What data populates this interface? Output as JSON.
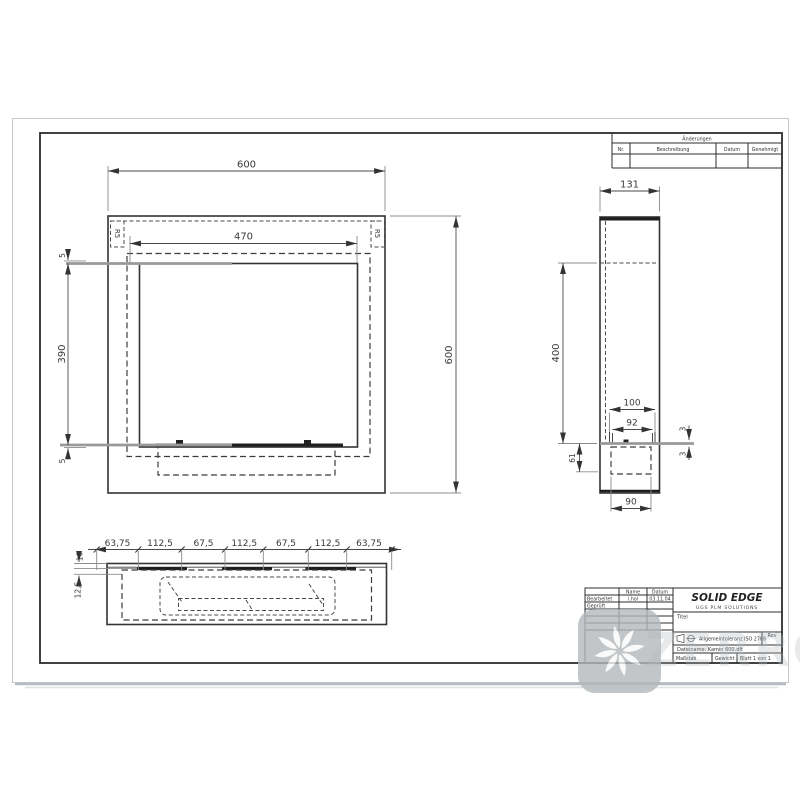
{
  "watermark": {
    "text": "ZERRO"
  },
  "revision_table": {
    "header": "Änderungen",
    "col_nr": "Nr.",
    "col_desc": "Beschreibung",
    "col_date": "Datum",
    "col_appr": "Genehmigt"
  },
  "title_block": {
    "brand": "SOLID EDGE",
    "brand_sub": "UGS PLM SOLUTIONS",
    "col_name": "Name",
    "col_date": "Datum",
    "row1_label": "Bearbeitet",
    "row1_name": "i.hol",
    "row1_date": "03.11.04",
    "row2_label": "Geprüft",
    "title_label": "Titel",
    "tolerance_note": "Allgemeintoleranz ISO 2768",
    "rev_label": "Rev",
    "filename": "Dateiname: Kamin 600.dft",
    "scale_label": "Maßstab",
    "weight_label": "Gewicht",
    "sheet_label": "Blatt 1 von 1"
  },
  "front_view": {
    "width": "600",
    "height": "600",
    "inner_width": "470",
    "inner_height": "390",
    "gap_top": "5",
    "gap_bottom": "5",
    "corner_left": "R5",
    "corner_right": "R5"
  },
  "side_view": {
    "width": "131",
    "height": "400",
    "slot_outer": "100",
    "slot_inner": "92",
    "lip_top": "3",
    "lip_bottom": "3",
    "inset": "61",
    "base_width": "90"
  },
  "bottom_view": {
    "seg1": "63,75",
    "seg2": "112,5",
    "seg3": "67,5",
    "seg4": "112,5",
    "seg5": "67,5",
    "seg6": "112,5",
    "seg7": "63,75",
    "offset": "10",
    "depth": "12,5"
  }
}
